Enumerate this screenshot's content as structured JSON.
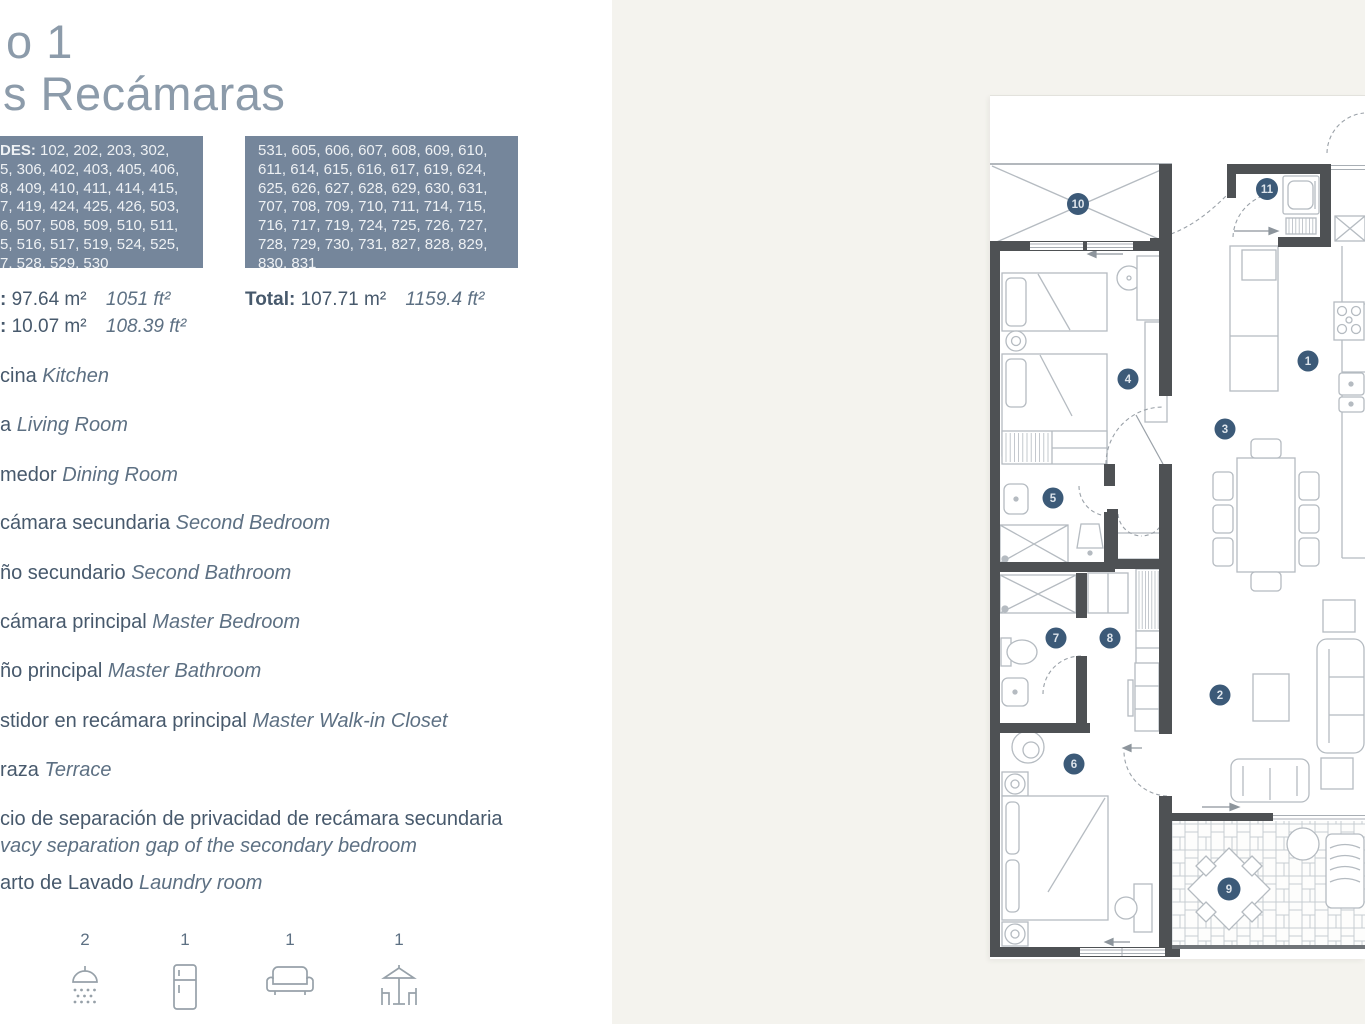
{
  "page": {
    "title_line1": "o 1",
    "title_line2": "s Recámaras"
  },
  "units": {
    "box1_prefix": "DES:",
    "box1_numbers": " 102, 202, 203, 302,\n5, 306, 402, 403, 405, 406,\n8, 409, 410, 411, 414, 415,\n7, 419, 424, 425, 426, 503,\n6, 507, 508, 509, 510, 511,\n5, 516, 517, 519, 524, 525,\n7, 528, 529, 530",
    "box2_numbers": "531, 605, 606, 607, 608, 609, 610,\n611, 614, 615, 616, 617, 619, 624,\n625, 626, 627, 628, 629, 630, 631,\n707, 708, 709, 710, 711, 714, 715,\n716, 717, 719, 724, 725, 726, 727,\n728, 729, 730, 731, 827, 828, 829,\n830, 831"
  },
  "areas": {
    "interior_label": ":",
    "interior_m2": "97.64 m²",
    "interior_ft2": "1051 ft²",
    "terrace_label": ":",
    "terrace_m2": "10.07 m²",
    "terrace_ft2": "108.39 ft²",
    "total_label": "Total:",
    "total_m2": "107.71 m²",
    "total_ft2": "1159.4 ft²"
  },
  "rooms": [
    {
      "es": "cina",
      "en": "Kitchen"
    },
    {
      "es": "a",
      "en": "Living Room"
    },
    {
      "es": "medor",
      "en": "Dining Room"
    },
    {
      "es": "cámara secundaria",
      "en": "Second Bedroom"
    },
    {
      "es": "ño secundario",
      "en": "Second Bathroom"
    },
    {
      "es": "cámara principal",
      "en": "Master Bedroom"
    },
    {
      "es": "ño principal",
      "en": "Master Bathroom"
    },
    {
      "es": "stidor en recámara principal",
      "en": "Master Walk-in Closet"
    },
    {
      "es": "raza",
      "en": "Terrace"
    },
    {
      "es": "cio de separación de privacidad de recámara secundaria",
      "en": "vacy separation gap of the secondary bedroom"
    },
    {
      "es": "arto de Lavado",
      "en": "Laundry room"
    }
  ],
  "amenities": [
    {
      "count": "2",
      "icon": "shower"
    },
    {
      "count": "1",
      "icon": "refrigerator"
    },
    {
      "count": "1",
      "icon": "sofa"
    },
    {
      "count": "1",
      "icon": "terrace-set"
    }
  ],
  "plan": {
    "markers": [
      "1",
      "2",
      "3",
      "4",
      "5",
      "6",
      "7",
      "8",
      "9",
      "10",
      "11"
    ]
  },
  "colors": {
    "accent_slate": "#75869b",
    "marker_blue": "#3c5a78",
    "text_dark": "#47596c",
    "text_italic": "#5d7083",
    "wall": "#4e5154",
    "beige_bg": "#f4f3ee"
  }
}
